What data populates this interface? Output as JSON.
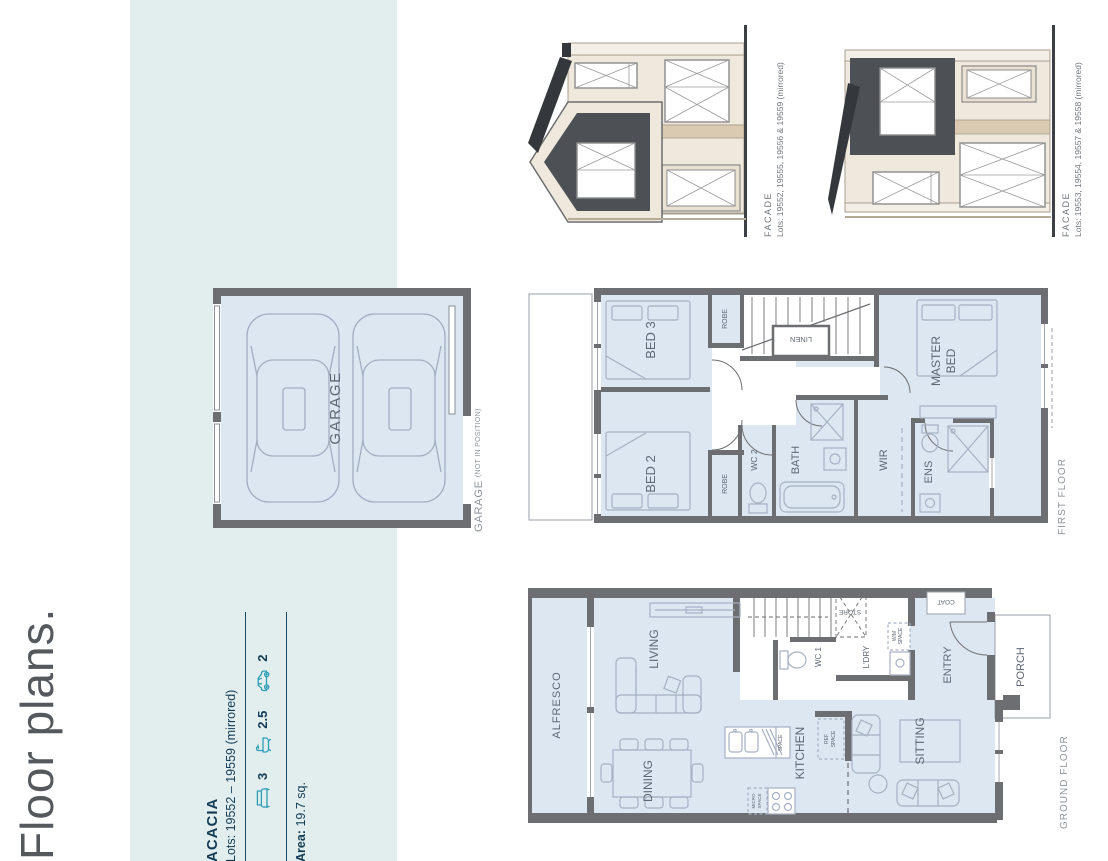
{
  "page": {
    "title": "Floor plans."
  },
  "summary": {
    "name": "ACACIA",
    "lots": "Lots: 19552 – 19559 (mirrored)",
    "beds": "3",
    "baths": "2.5",
    "cars": "2",
    "area_label": "Area:",
    "area_value": "19.7 sq."
  },
  "facades": {
    "f1_label": "FACADE",
    "f1_lots": "Lots: 19552, 19555, 19556 & 19559 (mirrored)",
    "f2_label": "FACADE",
    "f2_lots": "Lots: 19553, 19554, 19557 & 19558 (mirrored)"
  },
  "garage_plan": {
    "room": "GARAGE",
    "caption": "GARAGE",
    "caption_note": "(NOT IN POSITION)"
  },
  "first_floor": {
    "caption": "FIRST FLOOR",
    "rooms": {
      "bed3": "BED 3",
      "bed2": "BED 2",
      "robe": "ROBE",
      "wc2": "WC 2",
      "bath": "BATH",
      "linen": "LINEN",
      "wir": "WIR",
      "ens": "ENS",
      "master1": "MASTER",
      "master2": "BED"
    }
  },
  "ground_floor": {
    "caption": "GROUND FLOOR",
    "rooms": {
      "alfresco": "ALFRESCO",
      "living": "LIVING",
      "dining": "DINING",
      "kitchen": "KITCHEN",
      "sitting": "SITTING",
      "entry": "ENTRY",
      "porch": "PORCH",
      "ldry": "L'DRY",
      "wc1": "WC 1",
      "store": "STORE",
      "coat": "COAT",
      "wm": "W/M",
      "ref": "REF",
      "micro": "MICRO",
      "space": "SPACE"
    }
  },
  "colors": {
    "band": "#e2eeee",
    "room_fill": "#dce7f2",
    "wall": "#6d6e71",
    "furniture_stroke": "#a6b1c3",
    "plan_text": "#5e6774",
    "navy": "#123c55",
    "teal": "#2d9db6",
    "cream": "#efe8dc",
    "beige": "#d9cab1",
    "dark_panel": "#4d5156"
  }
}
